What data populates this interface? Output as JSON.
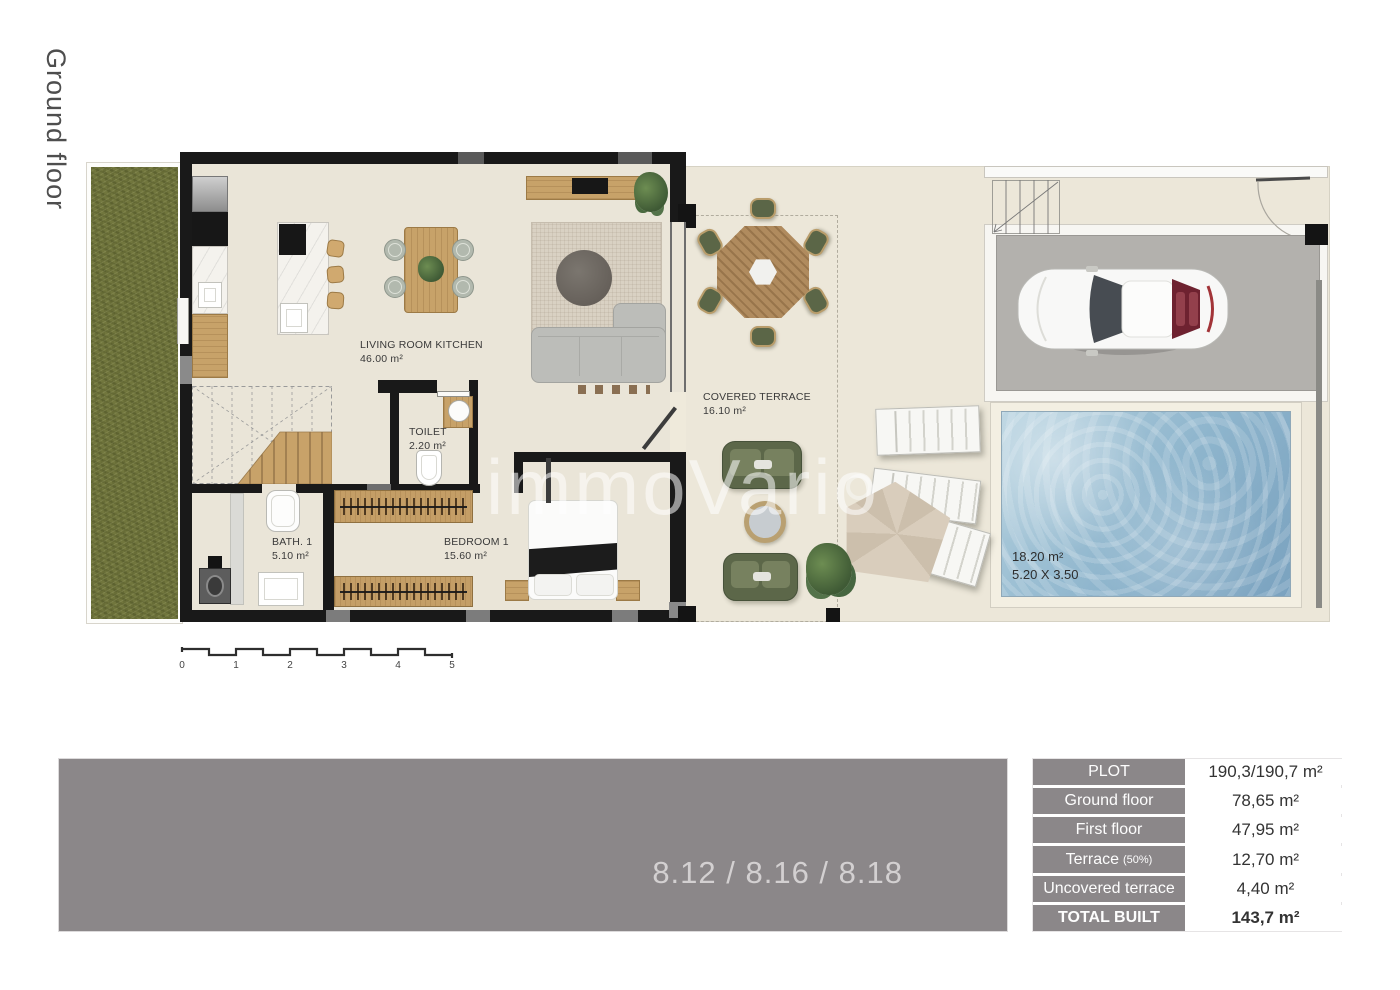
{
  "page": {
    "floor_label": "Ground floor",
    "watermark": "immoVario",
    "units": "8.12 / 8.16 / 8.18"
  },
  "rooms": {
    "living_room_kitchen": {
      "name": "LIVING ROOM KITCHEN",
      "area": "46.00 m²"
    },
    "toilet": {
      "name": "TOILET",
      "area": "2.20 m²"
    },
    "bath_1": {
      "name": "BATH. 1",
      "area": "5.10 m²"
    },
    "bedroom_1": {
      "name": "BEDROOM 1",
      "area": "15.60 m²"
    },
    "covered_terrace": {
      "name": "COVERED TERRACE",
      "area": "16.10 m²"
    }
  },
  "pool": {
    "area": "18.20 m²",
    "dimensions": "5.20 X 3.50"
  },
  "scale_bar": {
    "ticks": [
      "0",
      "1",
      "2",
      "3",
      "4",
      "5"
    ]
  },
  "summary_table": {
    "rows": [
      {
        "label": "PLOT",
        "value": "190,3/190,7 m²"
      },
      {
        "label": "Ground floor",
        "value": "78,65 m²"
      },
      {
        "label": "First floor",
        "value": "47,95 m²"
      },
      {
        "label": "Terrace",
        "label_note": "(50%)",
        "value": "12,70 m²"
      },
      {
        "label": "Uncovered terrace",
        "value": "4,40 m²"
      },
      {
        "label": "TOTAL BUILT",
        "value": "143,7 m²"
      }
    ]
  },
  "colors": {
    "wall": "#191919",
    "floor": "#eae5d8",
    "outdoor_ground": "#ece7d9",
    "grass": "#71763d",
    "driveway": "#b3b1ad",
    "pool_water": "#8db4cc",
    "panel_gray": "#8b8789",
    "wood": "#c7a269",
    "outdoor_green": "#5c6749"
  }
}
